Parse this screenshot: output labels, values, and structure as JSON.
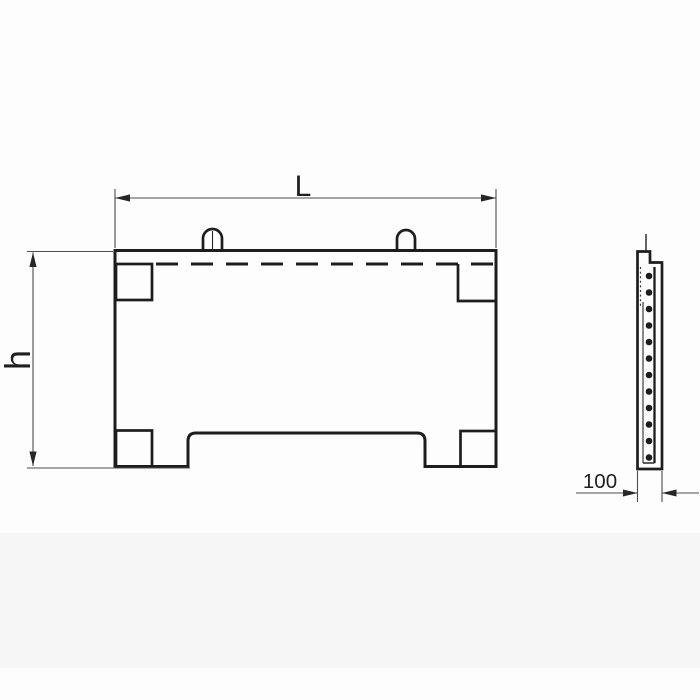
{
  "drawing": {
    "type": "precast-panel-technical-drawing",
    "labels": {
      "length": "L",
      "height": "h",
      "thickness": "100"
    },
    "colors": {
      "background": "#fdfdfd",
      "outline": "#1d1d1d",
      "dimension_lines": "#4d4d4d",
      "text": "#1f1f1f"
    }
  }
}
